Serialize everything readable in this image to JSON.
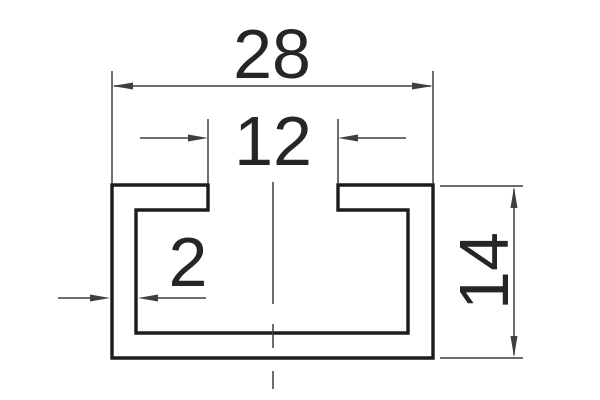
{
  "drawing": {
    "title": "c-channel-profile-cross-section",
    "dimensions": {
      "overall_width": "28",
      "slot_width": "12",
      "wall_thickness": "2",
      "overall_height": "14"
    }
  },
  "colors": {
    "background": "#ffffff",
    "profile_stroke": "#1c1c1c",
    "dimension_line": "#3f3f3f",
    "text": "#262626"
  }
}
